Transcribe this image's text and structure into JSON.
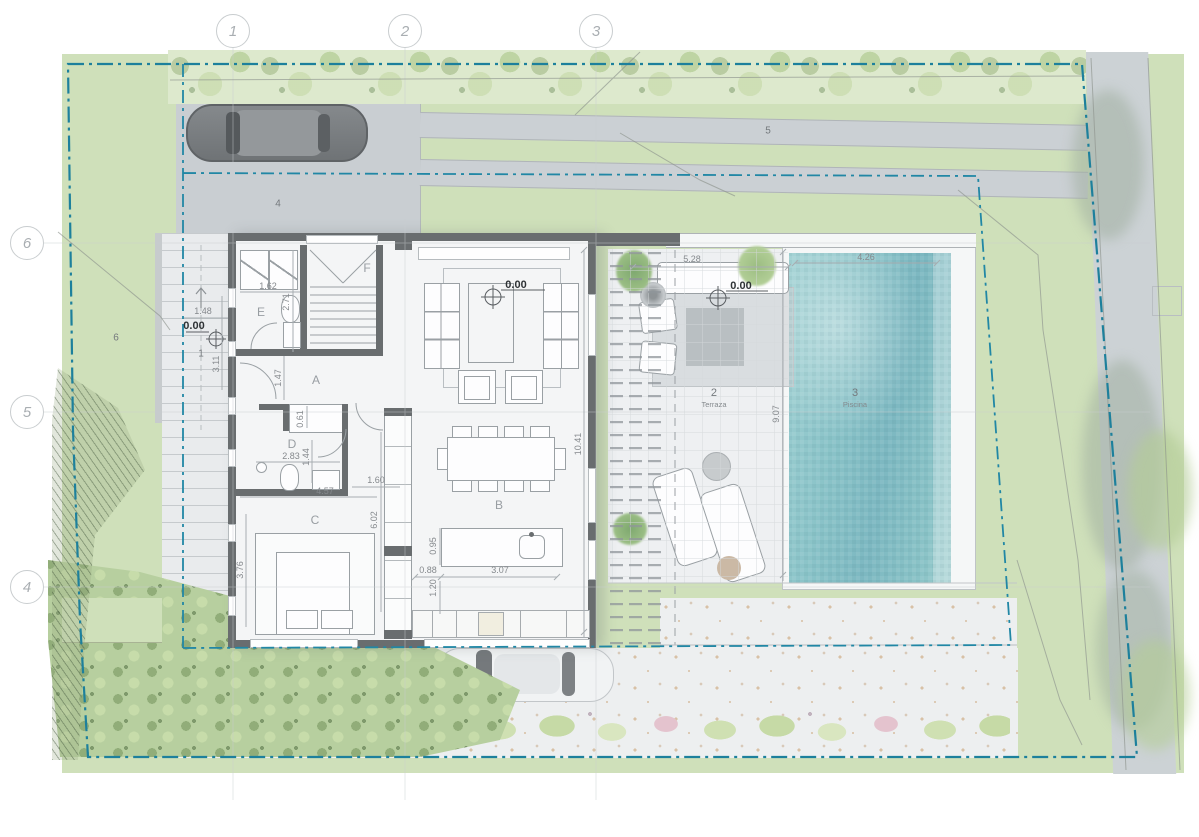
{
  "plan": {
    "title": "Villa ground floor site plan",
    "grid_top": [
      {
        "label": "1"
      },
      {
        "label": "2"
      },
      {
        "label": "3"
      }
    ],
    "grid_left": [
      {
        "label": "6"
      },
      {
        "label": "5"
      },
      {
        "label": "4"
      }
    ],
    "rooms": [
      {
        "letter": "A"
      },
      {
        "letter": "B"
      },
      {
        "letter": "C"
      },
      {
        "letter": "D"
      },
      {
        "letter": "E"
      },
      {
        "letter": "F"
      }
    ],
    "areas": [
      {
        "number": "1",
        "name": ""
      },
      {
        "number": "2",
        "name": "Terraza"
      },
      {
        "number": "3",
        "name": "Piscina"
      },
      {
        "number": "4",
        "name": ""
      },
      {
        "number": "5",
        "name": ""
      },
      {
        "number": "6",
        "name": ""
      }
    ],
    "levels": [
      {
        "value": "0.00"
      },
      {
        "value": "0.00"
      },
      {
        "value": "0.00"
      }
    ],
    "dimensions": [
      {
        "value": "1.62"
      },
      {
        "value": "2.71"
      },
      {
        "value": "1.48"
      },
      {
        "value": "3.11"
      },
      {
        "value": "1.47"
      },
      {
        "value": "0.61"
      },
      {
        "value": "2.83"
      },
      {
        "value": "1.44"
      },
      {
        "value": "4.57"
      },
      {
        "value": "1.60"
      },
      {
        "value": "6.02"
      },
      {
        "value": "3.76"
      },
      {
        "value": "0.95"
      },
      {
        "value": "0.88"
      },
      {
        "value": "3.07"
      },
      {
        "value": "1.20"
      },
      {
        "value": "10.41"
      },
      {
        "value": "5.28"
      },
      {
        "value": "9.07"
      },
      {
        "value": "4.26"
      }
    ],
    "colors": {
      "boundary": "#1d809c",
      "setback": "#2187a5",
      "pool": "#8cc5c9",
      "lawn": "#cfe0ba",
      "wall": "#696d6f",
      "hedge": "#dcead0",
      "road": "#ccd2d5",
      "terrace": "#eef0f2"
    }
  }
}
